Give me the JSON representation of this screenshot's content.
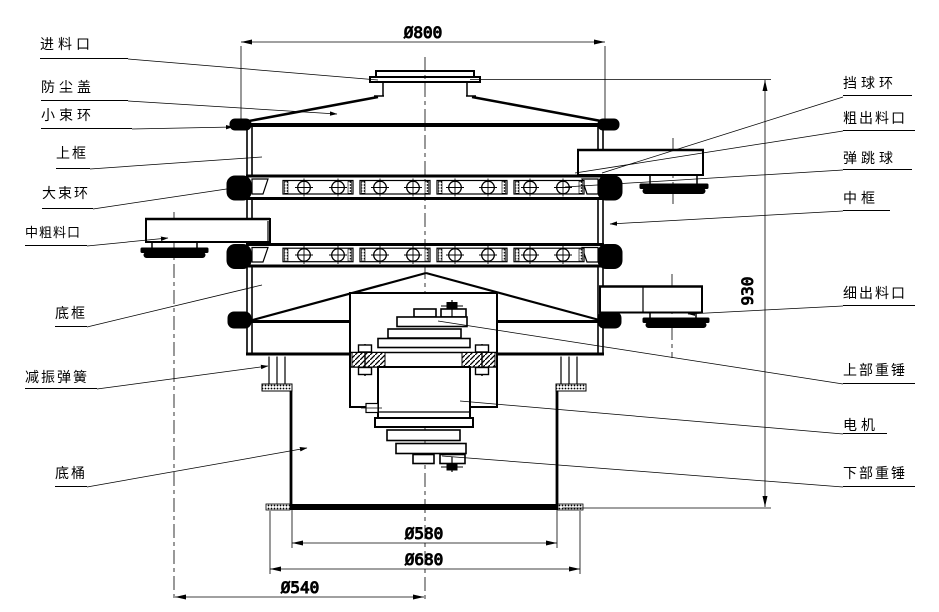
{
  "drawing": {
    "kind": "vibrating-sieve-sectional-diagram",
    "background": "#ffffff",
    "line_color": "#000000"
  },
  "labels": {
    "left": [
      {
        "id": "feed-inlet",
        "text": "进料口"
      },
      {
        "id": "dust-cover",
        "text": "防尘盖"
      },
      {
        "id": "small-clamp-ring",
        "text": "小束环"
      },
      {
        "id": "upper-frame",
        "text": "上框"
      },
      {
        "id": "large-clamp-ring",
        "text": "大束环"
      },
      {
        "id": "mid-coarse-outlet",
        "text": "中粗料口"
      },
      {
        "id": "bottom-frame",
        "text": "底框"
      },
      {
        "id": "damping-spring",
        "text": "减振弹簧"
      },
      {
        "id": "base-barrel",
        "text": "底桶"
      }
    ],
    "right": [
      {
        "id": "ball-stop-ring",
        "text": "挡球环"
      },
      {
        "id": "coarse-outlet",
        "text": "粗出料口"
      },
      {
        "id": "bouncing-ball",
        "text": "弹跳球"
      },
      {
        "id": "middle-frame",
        "text": "中框"
      },
      {
        "id": "fine-outlet",
        "text": "细出料口"
      },
      {
        "id": "upper-weight",
        "text": "上部重锤"
      },
      {
        "id": "motor",
        "text": "电机"
      },
      {
        "id": "lower-weight",
        "text": "下部重锤"
      }
    ]
  },
  "dimensions": {
    "top_diameter": "Ø800",
    "overall_height": "930",
    "barrel_diameter": "Ø580",
    "base_flange_diameter": "Ø680",
    "outlet_circle_diameter": "Ø540"
  }
}
